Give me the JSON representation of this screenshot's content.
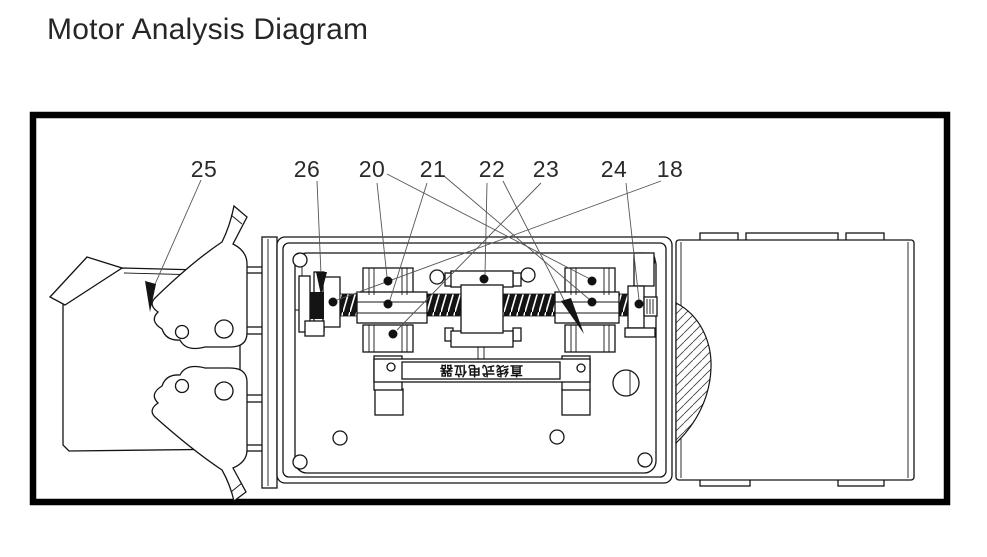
{
  "page": {
    "title": "Motor Analysis Diagram",
    "background_color": "#ffffff"
  },
  "diagram": {
    "frame_color": "#000000",
    "line_color": "#141414",
    "leader_color": "#555555",
    "component_label": "直线式电位器",
    "callouts": [
      {
        "label": "25"
      },
      {
        "label": "26"
      },
      {
        "label": "20"
      },
      {
        "label": "21"
      },
      {
        "label": "22"
      },
      {
        "label": "23"
      },
      {
        "label": "24"
      },
      {
        "label": "18"
      }
    ]
  }
}
